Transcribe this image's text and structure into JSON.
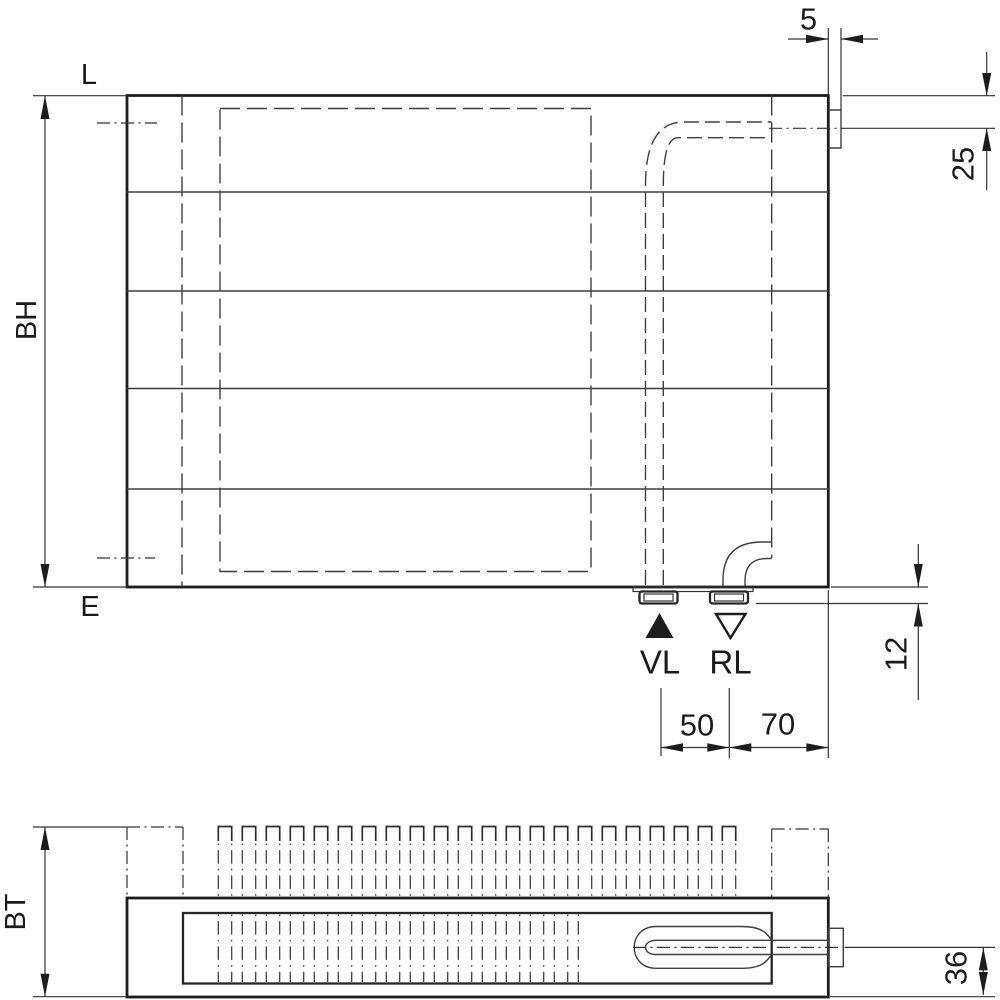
{
  "drawing": {
    "title": "Radiator technical dimension drawing (front elevation and plan view)",
    "fin_count": 22
  },
  "front_view": {
    "label_top_left": "L",
    "label_bottom_left": "E",
    "height_label": "BH",
    "supply_label": "VL",
    "return_label": "RL",
    "supply_symbol": "filled-up-triangle",
    "return_symbol": "open-down-triangle",
    "dim_valve_protrusion": "5",
    "dim_axis_from_top": "25",
    "dim_stub_protrusion": "12",
    "dim_vl_to_rl": "50",
    "dim_rl_to_edge": "70"
  },
  "plan_view": {
    "depth_label": "BT",
    "dim_axis_to_face": "36"
  },
  "colors": {
    "line_main": "#1d1d1d",
    "line_thin": "#3e3e3e",
    "background": "#ffffff"
  }
}
